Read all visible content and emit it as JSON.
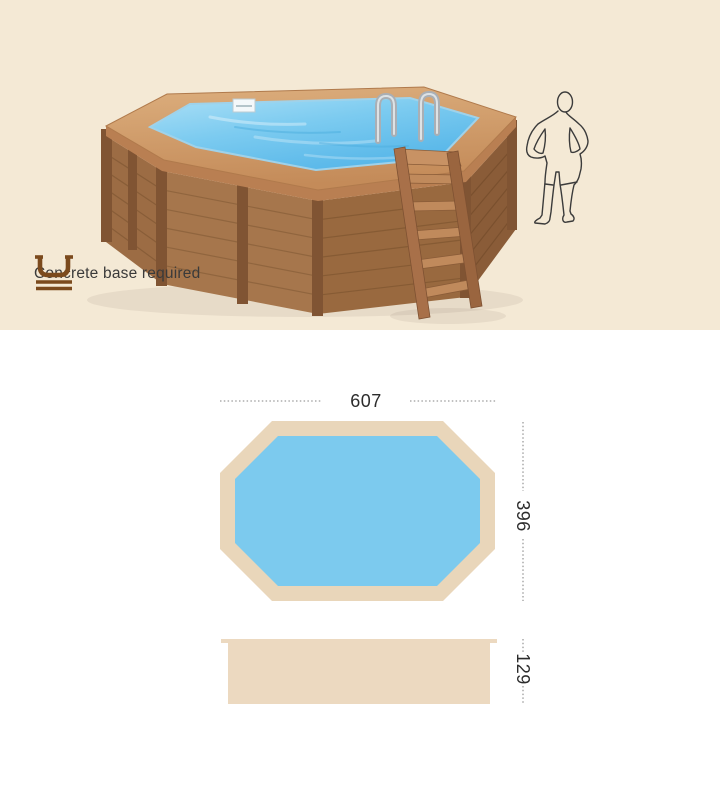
{
  "hero": {
    "background_color": "#f4e9d5",
    "note": {
      "label": "Concrete base required"
    },
    "scene": {
      "pool_water_color": "#5cb9e9",
      "pool_wood_color": "#a6764c",
      "rim_wood_color": "#d2a06e"
    }
  },
  "icons": {
    "concrete_base": "concrete-base-icon",
    "scale_figure": "human-outline-figure"
  },
  "specs": {
    "top_view": {
      "width_label": "607",
      "depth_label": "396"
    },
    "side_view": {
      "height_label": "129"
    },
    "colors": {
      "frame_tan": "#e9d6ba",
      "side_view_tan": "#ecd9c0",
      "water_blue": "#7ccaee",
      "dimension_line_gray": "#9c9c9c",
      "dimension_text": "#2c2c2c",
      "icon_brown": "#7b4a1d"
    }
  }
}
